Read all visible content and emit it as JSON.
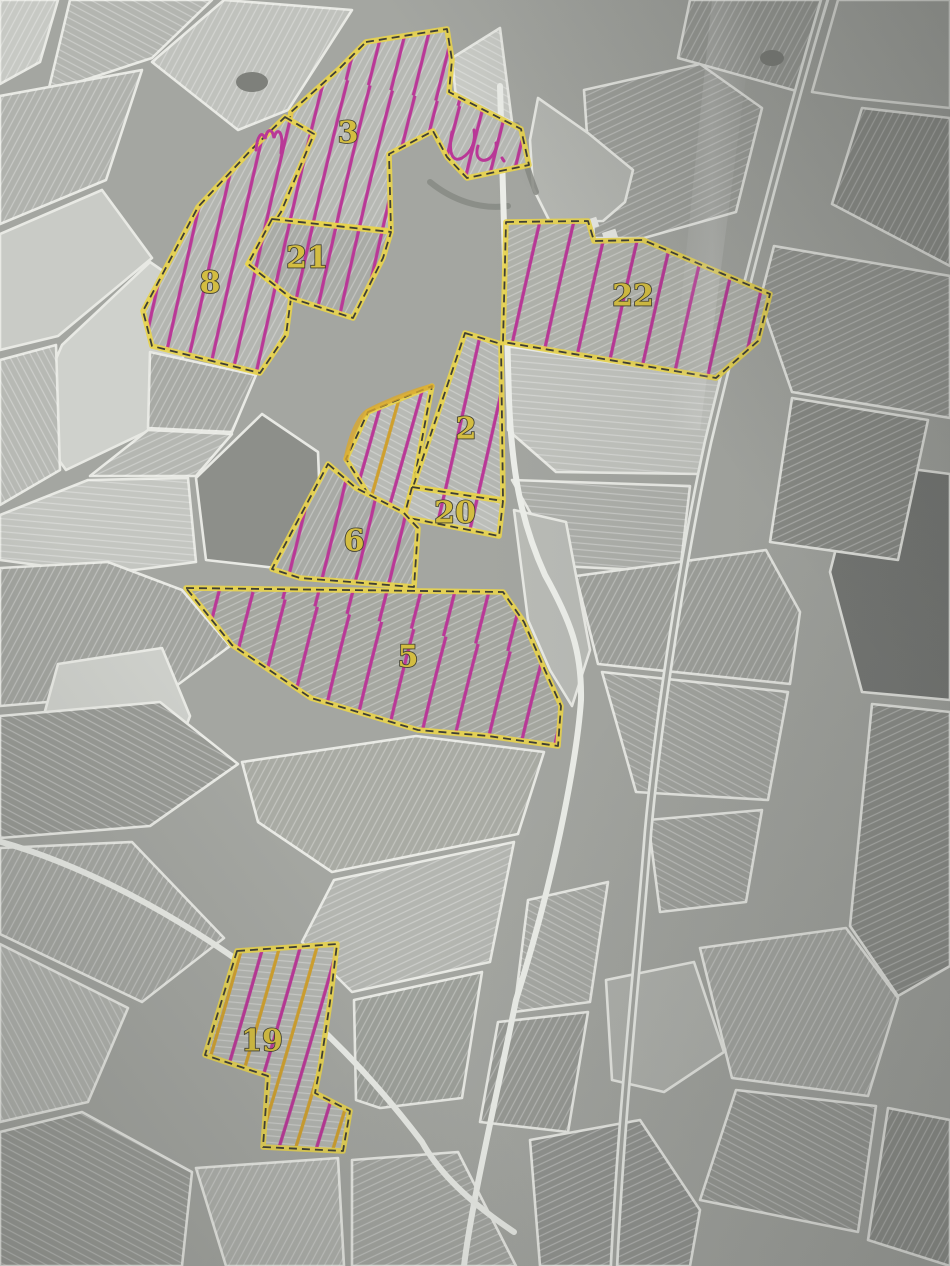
{
  "image_type": "photographed aerial cadastral map with hand-annotated vineyard parcels",
  "parcel_numbers_visible": [
    "3",
    "8",
    "21",
    "22",
    "2",
    "20",
    "6",
    "5",
    "19"
  ],
  "annotation": {
    "outline": "#e8d44d",
    "outline_core": "#3f3f35",
    "hatch_pink": "#b93897",
    "hatch_yellow": "#cfa02e",
    "marker_yellow": "#d9a92e",
    "label_fill": "#d3bd41",
    "label_stroke": "#403f31",
    "road_white": "#eceee9",
    "border_white": "#e8e9e4",
    "base_gray": "#a4a6a1"
  },
  "parcels": [
    {
      "number": "3",
      "label_pos": [
        348,
        133
      ],
      "hatch": "dense",
      "fill": "#b7b9b4",
      "stripe": "a",
      "points": "366,42 447,29 452,60 449,92 521,129 529,165 467,178 447,157 433,131 389,154 391,231 272,219 291,112 340,68"
    },
    {
      "number": "8",
      "label_pos": [
        210,
        283
      ],
      "hatch": "dense",
      "fill": "#b4b6b1",
      "stripe": "a",
      "points": "285,117 314,134 281,212 248,264 291,298 286,335 260,373 152,346 143,311 198,207 252,149"
    },
    {
      "number": "21",
      "label_pos": [
        307,
        258
      ],
      "hatch": "dense",
      "fill": "#a9aba6",
      "stripe": "a",
      "points": "272,219 391,232 383,258 353,318 291,298 248,264"
    },
    {
      "number": "22",
      "label_pos": [
        633,
        296
      ],
      "hatch": "normal",
      "fill": "#b0b2ab",
      "stripe": "c",
      "points": "506,222 588,221 594,241 643,240 770,294 758,341 716,378 503,342"
    },
    {
      "number": "2",
      "label_pos": [
        466,
        429
      ],
      "hatch": "normal",
      "fill": "#b5b7b2",
      "stripe": "b",
      "points": "465,333 501,344 503,500 413,487"
    },
    {
      "number": "20",
      "label_pos": [
        455,
        513
      ],
      "hatch": "normal",
      "fill": "#bcbeb9",
      "stripe": "b",
      "points": "412,487 503,501 499,536 404,517"
    },
    {
      "number": "6",
      "label_pos": [
        354,
        541
      ],
      "hatch": "normal",
      "fill": "#a8aaa5",
      "stripe": "a",
      "points": "328,464 356,488 403,512 418,528 414,587 300,578 272,569"
    },
    {
      "number": "5",
      "label_pos": [
        408,
        657
      ],
      "hatch": "normal",
      "fill": "#a5a7a0",
      "stripe": "c",
      "points": "186,588 503,592 524,622 544,668 561,706 558,746 488,736 418,730 311,698 232,645"
    },
    {
      "number": "19",
      "label_pos": [
        262,
        1041
      ],
      "hatch": "pink-yellow",
      "fill": "#b3b5b0",
      "stripe": "e",
      "points": "237,951 337,944 330,1002 321,1062 315,1093 350,1111 343,1151 263,1147 268,1076 205,1055"
    }
  ],
  "unnumbered_highlights": [
    {
      "points": "368,412 432,386 413,487 404,517 377,508 346,459",
      "hatch": "pink-yellow",
      "fill": "#b8bab5",
      "stripe": "b",
      "marker_edge": "M346,459 C352,430 361,414 370,410 C392,399 414,391 432,386"
    }
  ],
  "scribbles": [
    {
      "d": "M256,150 C257,137 262,129 265,139 C267,129 272,127 274,138 C276,129 281,129 282,141 L281,153"
    },
    {
      "d": "M452,132 C448,152 452,163 462,158 C472,152 476,140 474,130"
    },
    {
      "d": "M478,146 C474,158 482,164 490,158 C495,153 497,147 496,143"
    },
    {
      "d": "M502,158 L504,161"
    }
  ],
  "fields": [
    {
      "p": "0,0 58,0 40,62 0,84",
      "f": "#c7c9c4",
      "s": "a"
    },
    {
      "p": "70,0 212,0 152,58 48,92",
      "f": "#b3b5b0",
      "s": "b"
    },
    {
      "p": "224,0 352,10 288,110 238,130 152,62",
      "f": "#c0c2bd",
      "s": "a"
    },
    {
      "p": "0,96 142,70 106,180 0,224",
      "f": "#b0b2ad",
      "s": "a"
    },
    {
      "p": "0,234 102,190 152,258 58,336 0,350",
      "f": "#c9cbc6",
      "s": ""
    },
    {
      "p": "62,345 150,262 208,302 150,430 66,470 30,420",
      "f": "#cfd1cc",
      "s": ""
    },
    {
      "p": "0,360 56,345 60,470 0,505",
      "f": "#b7b9b4",
      "s": "d"
    },
    {
      "p": "0,515 88,480 188,478 196,562 104,574 0,560",
      "f": "#c4c6c1",
      "s": "e"
    },
    {
      "p": "150,352 256,375 232,432 148,428",
      "f": "#a8aaa5",
      "s": "a"
    },
    {
      "p": "148,430 232,434 196,476 90,476",
      "f": "#b5b7b2",
      "s": "c"
    },
    {
      "p": "196,478 262,414 318,452 322,556 276,568 206,560",
      "f": "#8d8f8a",
      "s": ""
    },
    {
      "p": "0,568 108,562 182,590 230,646 168,692 0,706",
      "f": "#a2a49f",
      "s": "a"
    },
    {
      "p": "58,664 162,648 190,716 174,758 72,768 42,722",
      "f": "#cdcfca",
      "s": ""
    },
    {
      "p": "0,716 160,702 238,764 150,826 0,838",
      "f": "#989a95",
      "s": "b"
    },
    {
      "p": "0,848 132,842 224,938 142,1002 0,934",
      "f": "#a6a8a3",
      "s": "a"
    },
    {
      "p": "0,944 128,1008 88,1102 0,1122",
      "f": "#b2b4af",
      "s": "d"
    },
    {
      "p": "0,1132 82,1112 192,1172 182,1266 0,1266",
      "f": "#9a9c97",
      "s": "b"
    },
    {
      "p": "196,1168 338,1158 344,1266 226,1266",
      "f": "#b0b2ad",
      "s": "a"
    },
    {
      "p": "352,1160 458,1152 516,1266 352,1266",
      "f": "#a4a6a1",
      "s": "c"
    },
    {
      "p": "452,58 500,28 512,122 456,98",
      "f": "#c9cbc6",
      "s": "b"
    },
    {
      "p": "584,90 700,64 762,108 736,212 644,238 594,238",
      "f": "#9fa19c",
      "s": "c"
    },
    {
      "p": "538,98 588,133 633,170 625,202 603,221 550,222 533,188 530,140",
      "f": "#b5b7b2",
      "s": ""
    },
    {
      "p": "690,0 828,0 800,92 678,58",
      "f": "#9b9d98",
      "s": "a"
    },
    {
      "p": "838,0 950,0 950,108 852,98 812,92",
      "f": "#a8aaa5",
      "s": ""
    },
    {
      "p": "950,118 862,108 832,204 950,266",
      "f": "#8f918c",
      "s": "a"
    },
    {
      "p": "774,246 950,276 950,418 792,392 760,300",
      "f": "#969893",
      "s": "c"
    },
    {
      "p": "508,346 723,380 700,474 556,472 508,430",
      "f": "#c0c2bd",
      "s": "e"
    },
    {
      "p": "512,480 690,486 680,572 560,566",
      "f": "#adafaa",
      "s": "e"
    },
    {
      "p": "576,576 766,550 800,612 790,684 598,664",
      "f": "#9ea09b",
      "s": "a"
    },
    {
      "p": "858,462 950,474 950,700 862,692 830,572",
      "f": "#787a77",
      "s": ""
    },
    {
      "p": "792,398 928,420 898,560 770,542",
      "f": "#8b8d88",
      "s": "c"
    },
    {
      "p": "602,672 788,692 768,800 636,792",
      "f": "#a3a5a0",
      "s": "b"
    },
    {
      "p": "242,762 416,736 544,752 518,834 332,872 258,822",
      "f": "#a9aba4",
      "s": "a"
    },
    {
      "p": "334,880 514,842 490,962 352,992 302,942",
      "f": "#b4b6b1",
      "s": "c"
    },
    {
      "p": "354,1000 482,972 462,1098 380,1108 356,1100",
      "f": "#9da09a",
      "s": "a"
    },
    {
      "p": "528,900 608,882 590,1002 514,1012",
      "f": "#a7a9a4",
      "s": "b"
    },
    {
      "p": "498,1022 588,1012 568,1132 480,1122",
      "f": "#989a95",
      "s": "a"
    },
    {
      "p": "648,820 762,810 746,902 660,912",
      "f": "#a0a29d",
      "s": "b"
    },
    {
      "p": "700,948 846,928 898,998 868,1096 732,1078",
      "f": "#a6a8a3",
      "s": "a"
    },
    {
      "p": "872,704 950,712 950,966 898,996 850,926",
      "f": "#8e908b",
      "s": "c"
    },
    {
      "p": "736,1090 876,1106 858,1232 700,1200",
      "f": "#999b96",
      "s": "b"
    },
    {
      "p": "888,1108 950,1120 950,1266 868,1240",
      "f": "#8f918c",
      "s": "a"
    },
    {
      "p": "530,1140 640,1120 700,1210 690,1266 540,1266",
      "f": "#929490",
      "s": "c"
    },
    {
      "p": "606,980 694,962 724,1052 664,1092 612,1080",
      "f": "#b0b2ad",
      "s": ""
    },
    {
      "p": "514,510 566,522 590,650 572,706 550,670 528,620",
      "f": "#b9bbb6",
      "s": ""
    }
  ],
  "roads": [
    {
      "d": "M500,86 C503,200 506,300 509,400 C512,470 520,520 545,575 C570,620 582,650 581,700 C578,745 560,860 516,1000 C498,1090 472,1200 464,1266",
      "w": 6,
      "c": "#eceee9",
      "core": ""
    },
    {
      "d": "M826,-6 C788,122 742,300 708,442 C682,562 658,722 648,832 C638,962 622,1102 614,1266",
      "w": 9,
      "c": "#e9ebe6",
      "core": "#a6a8a3"
    },
    {
      "d": "M-6,840 C84,864 182,918 262,978 C332,1032 384,1092 422,1142 C446,1186 496,1220 514,1232",
      "w": 6,
      "c": "#e9ebe6",
      "core": ""
    }
  ],
  "ponds": [
    {
      "cx": 252,
      "cy": 82,
      "rx": 16,
      "ry": 10
    },
    {
      "cx": 772,
      "cy": 58,
      "rx": 12,
      "ry": 8
    }
  ],
  "tree_lines": [
    {
      "d": "M517,125 C522,152 528,172 536,192",
      "w": 6
    },
    {
      "d": "M430,182 C452,200 480,210 508,206",
      "w": 6
    }
  ],
  "buildings": [
    {
      "x": 580,
      "y": 222,
      "w": 17,
      "h": 10,
      "r": -18
    },
    {
      "x": 602,
      "y": 233,
      "w": 14,
      "h": 9,
      "r": -18
    }
  ]
}
